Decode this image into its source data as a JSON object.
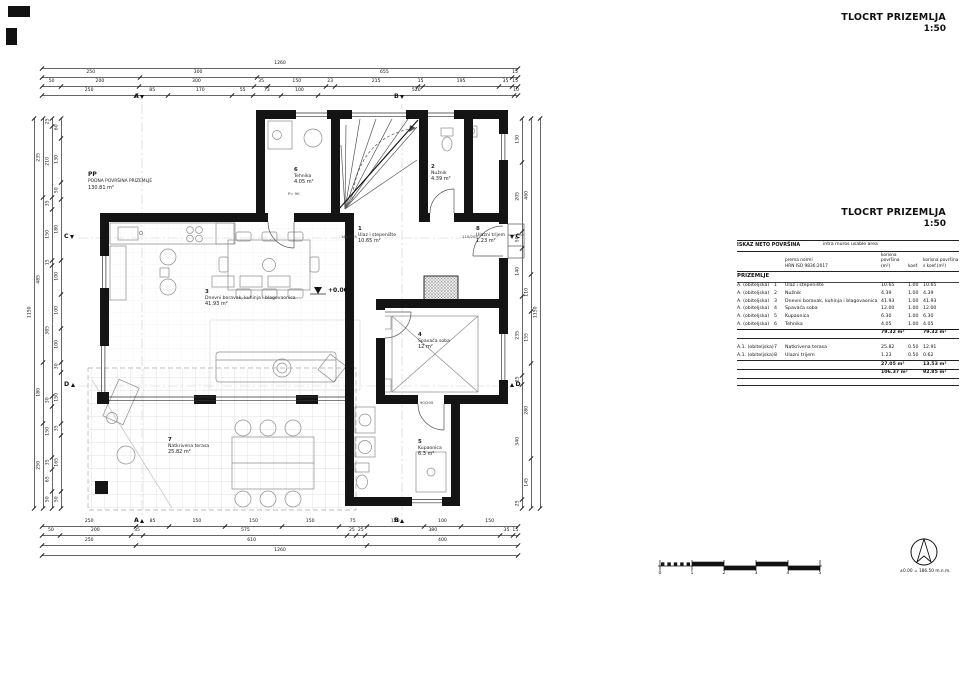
{
  "titles": {
    "top": {
      "title": "TLOCRT PRIZEMLJA",
      "scale": "1:50"
    },
    "mid": {
      "title": "TLOCRT PRIZEMLJA",
      "scale": "1:50"
    }
  },
  "area_table": {
    "header_left": "ISKAZ NETO POVRŠINA",
    "header_right": "intra muros usable area",
    "norm_line1": "prema normi",
    "norm_line2": "HRN ISO 9836:2017",
    "col_area": "korisna površina (m²)",
    "col_koef": "koef.",
    "col_area_koef": "korisna površina s koef.(m²)",
    "section": "PRIZEMLJE",
    "rows": [
      {
        "grp": "A. (obiteljska)",
        "num": "1",
        "name": "Ulaz i stepenište",
        "a": "10.65",
        "k": "1.00",
        "ak": "10.65"
      },
      {
        "grp": "A. (obiteljska)",
        "num": "2",
        "name": "Nužnik",
        "a": "4.39",
        "k": "1.00",
        "ak": "4.39"
      },
      {
        "grp": "A. (obiteljska)",
        "num": "3",
        "name": "Dnevni boravak, kuhinja i blagovaonica",
        "a": "41.93",
        "k": "1.00",
        "ak": "41.93"
      },
      {
        "grp": "A. (obiteljska)",
        "num": "4",
        "name": "Spavaća soba",
        "a": "12.00",
        "k": "1.00",
        "ak": "12.00"
      },
      {
        "grp": "A. (obiteljska)",
        "num": "5",
        "name": "Kupaonica",
        "a": "6.30",
        "k": "1.00",
        "ak": "6.30"
      },
      {
        "grp": "A. (obiteljska)",
        "num": "6",
        "name": "Tehnika",
        "a": "4.05",
        "k": "1.00",
        "ak": "4.05"
      }
    ],
    "sub1": {
      "a": "79.32 m²",
      "ak": "79.32 m²"
    },
    "rows2": [
      {
        "grp": "A.1. (obiteljska)",
        "num": "7",
        "name": "Natkrivena terasa",
        "a": "25.82",
        "k": "0.50",
        "ak": "12.91"
      },
      {
        "grp": "A.1. (obiteljska)",
        "num": "8",
        "name": "Ulazni trijem",
        "a": "1.23",
        "k": "0.50",
        "ak": "0.62"
      }
    ],
    "sub2": {
      "a": "27.05 m²",
      "ak": "13.53 m²"
    },
    "total": {
      "a": "106.37 m²",
      "ak": "92.85 m²"
    }
  },
  "plan": {
    "pp": {
      "code": "PP",
      "name": "PODNA POVRŠINA PRIZEMLJE",
      "area": "130.81 m²"
    },
    "elevation_marker": "+0.00",
    "rooms": [
      {
        "num": "1",
        "name": "Ulaz i stepenište",
        "area": "10.65 m²"
      },
      {
        "num": "2",
        "name": "Nužnik",
        "area": "4.39 m²"
      },
      {
        "num": "3",
        "name": "Dnevni boravak, kuhinja i blagovaonica",
        "area": "41.93 m²"
      },
      {
        "num": "4",
        "name": "Spavaća soba",
        "area": "12 m²"
      },
      {
        "num": "5",
        "name": "Kupaonica",
        "area": "6.3 m²"
      },
      {
        "num": "6",
        "name": "Tehnika",
        "area": "4.05 m²"
      },
      {
        "num": "7",
        "name": "Natkrivena terasa",
        "area": "25.82 m²"
      },
      {
        "num": "8",
        "name": "Ulazni trijem",
        "area": "1.23 m²"
      }
    ],
    "door_labels": [
      "160/205",
      "110/205",
      "90/205",
      "P= 90"
    ],
    "section_markers": [
      "A",
      "B",
      "C",
      "D"
    ]
  },
  "dimensions": {
    "top": [
      [
        1260
      ],
      [
        250,
        300,
        655,
        15
      ],
      [
        50,
        200,
        300,
        35,
        150,
        23,
        215,
        15,
        195,
        35,
        15
      ],
      [
        250,
        85,
        170,
        55,
        73,
        100,
        520,
        10
      ]
    ],
    "bottom": [
      [
        250,
        85,
        150,
        150,
        150,
        75,
        150,
        100,
        150
      ],
      [
        50,
        200,
        35,
        575,
        25,
        25,
        380,
        35,
        15
      ],
      [
        250,
        610,
        400
      ],
      [
        1260
      ]
    ],
    "left": [
      [
        1150
      ],
      [
        235,
        485,
        180,
        250
      ],
      [
        25,
        210,
        35,
        150,
        15,
        385,
        30,
        150,
        35,
        65,
        50
      ],
      [
        60,
        130,
        50,
        180,
        100,
        100,
        100,
        30,
        150,
        35,
        165,
        50
      ]
    ],
    "right": [
      [
        130,
        205,
        50,
        140,
        235,
        25,
        340,
        25
      ],
      [
        460,
        110,
        155,
        280,
        145
      ],
      [
        1150
      ]
    ]
  },
  "scale_bar": {
    "labels": [
      "0",
      "1",
      "2",
      "3",
      "4",
      "5"
    ]
  },
  "north": {
    "note": "±0.00 = 186.50 m.n.m."
  }
}
